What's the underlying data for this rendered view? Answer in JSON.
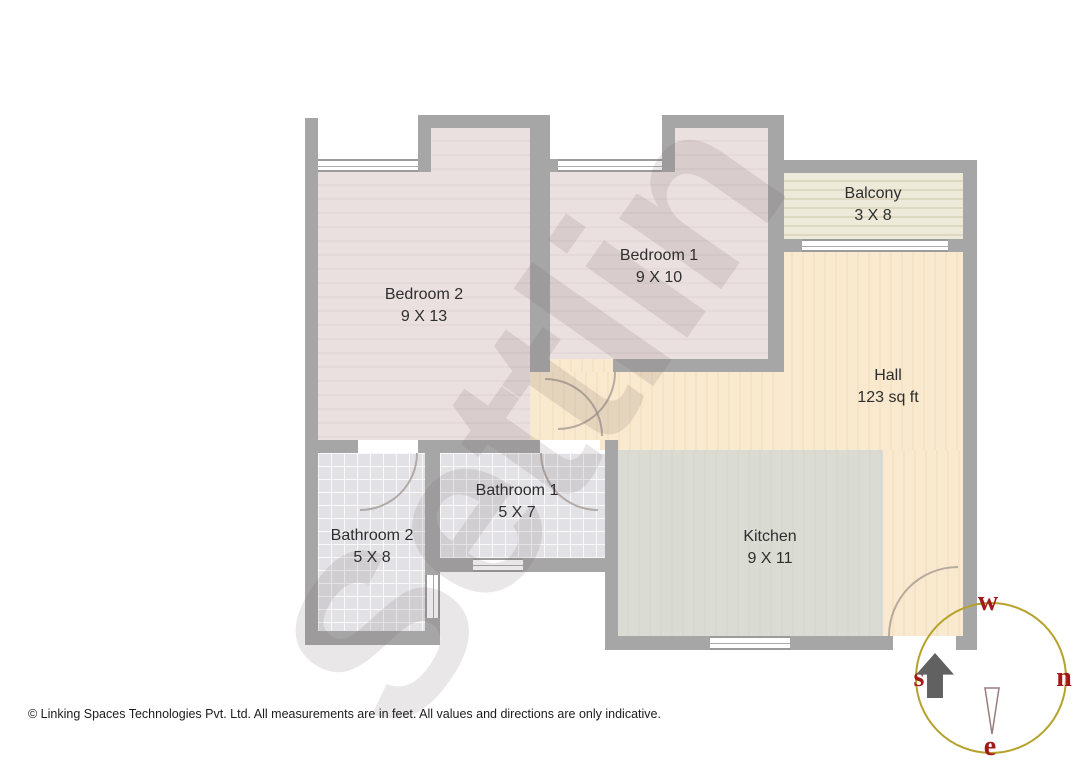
{
  "plan": {
    "title": "apartment-floor-plan",
    "units_note": "All measurements are in feet"
  },
  "rooms": [
    {
      "id": "bedroom2",
      "name": "Bedroom 2",
      "dimensions": "9 X 13"
    },
    {
      "id": "bedroom1",
      "name": "Bedroom 1",
      "dimensions": "9 X 10"
    },
    {
      "id": "balcony",
      "name": "Balcony",
      "dimensions": "3 X 8"
    },
    {
      "id": "hall",
      "name": "Hall",
      "dimensions": "123 sq ft"
    },
    {
      "id": "bathroom1",
      "name": "Bathroom 1",
      "dimensions": "5 X 7"
    },
    {
      "id": "bathroom2",
      "name": "Bathroom 2",
      "dimensions": "5 X 8"
    },
    {
      "id": "kitchen",
      "name": "Kitchen",
      "dimensions": "9 X 11"
    }
  ],
  "compass": {
    "top": "w",
    "right": "n",
    "left": "s",
    "bottom": "e",
    "circle_color": "#b5a22c",
    "letter_color": "#a51818"
  },
  "watermark": {
    "text": "Settlin"
  },
  "footer": {
    "text": "© Linking Spaces Technologies Pvt. Ltd. All measurements are in feet. All values and directions are only indicative."
  },
  "colors": {
    "wall": "#a6a6a6",
    "bedroom_floor": "#ebe0e0",
    "balcony_floor": "#edead9",
    "hall_floor": "#f9e9cf",
    "kitchen_floor": "#dadcd4",
    "bathroom_floor": "#e2e2e6"
  }
}
